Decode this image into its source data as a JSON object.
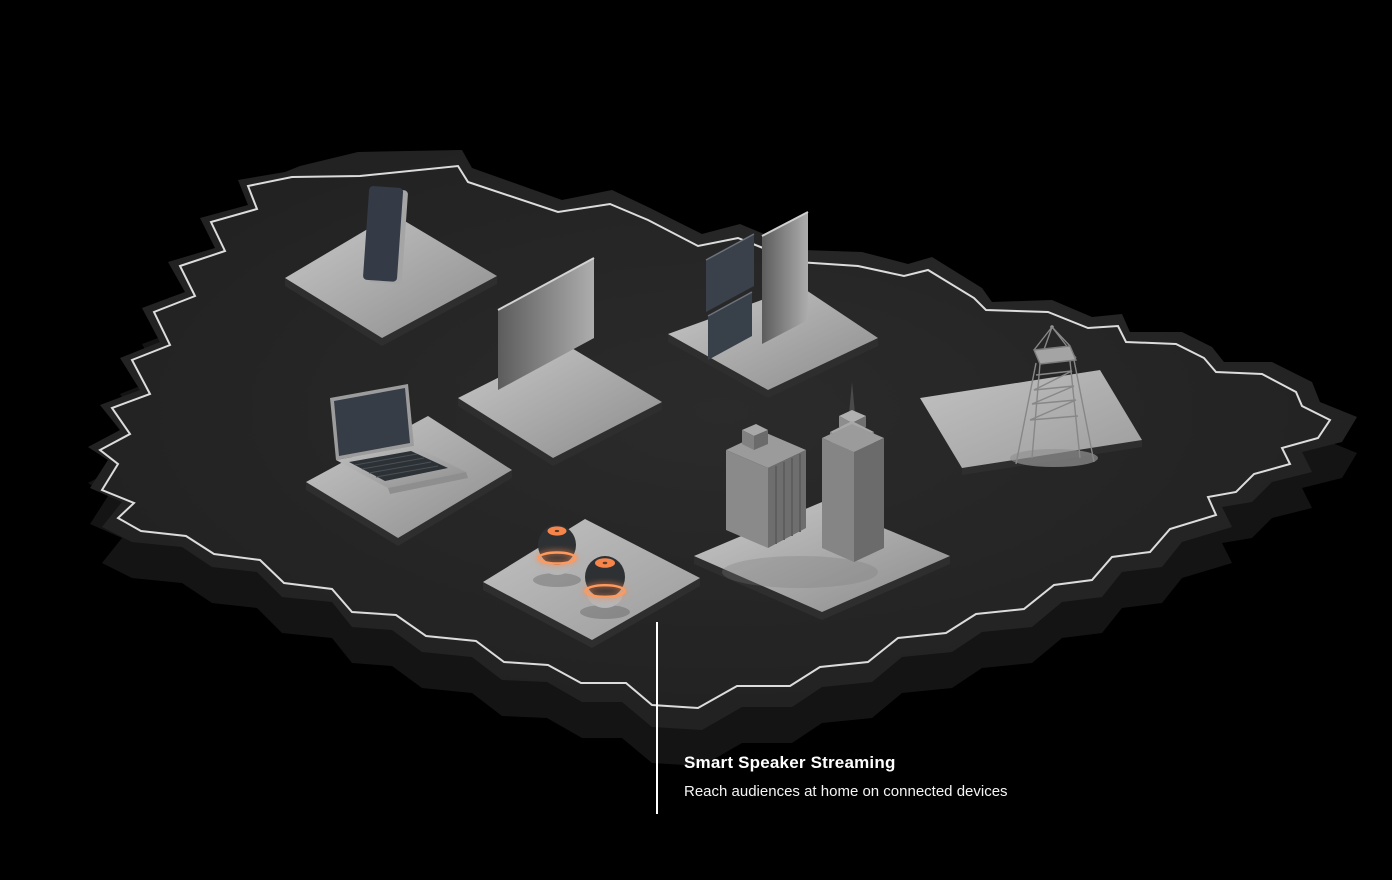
{
  "illustration": {
    "description": "Isometric 3D dark country map with white inner border line; gray platforms hold a smartphone, a display panel, digital signage screens, a broadcast lattice tower, a laptop, two smart speakers with glowing orange rings, and two city buildings",
    "colors": {
      "background": "#000000",
      "map_top": "#242424",
      "map_side": "#151515",
      "border_line": "#dcdcdc",
      "platform": "#aeaeae",
      "screen_dark": "#343b46",
      "accent_orange": "#ff8a4e",
      "callout": "#ffffff"
    },
    "objects": [
      {
        "name": "smartphone-on-platform"
      },
      {
        "name": "display-panel-on-platform"
      },
      {
        "name": "signage-screens-on-platform"
      },
      {
        "name": "broadcast-tower-on-platform"
      },
      {
        "name": "laptop-on-platform"
      },
      {
        "name": "smart-speakers-on-platform"
      },
      {
        "name": "city-buildings-on-platform"
      }
    ]
  },
  "callout": {
    "title": "Smart Speaker Streaming",
    "subtitle": "Reach audiences at home on connected devices"
  }
}
